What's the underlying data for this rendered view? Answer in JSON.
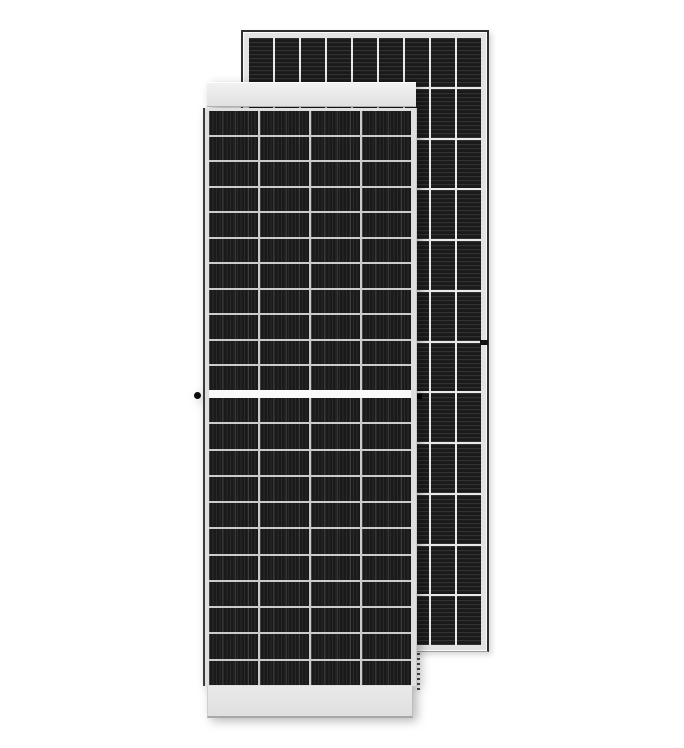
{
  "scene": {
    "description": "Product photo of two framed monocrystalline solar panels on a white background; a portrait half-cut-cell panel in front and a taller panel with horizontally striped cells behind it, offset to the upper right",
    "background_color": "#ffffff"
  },
  "colors": {
    "background": "#ffffff",
    "frame-light": "#e3e3e3",
    "frame-edge-dark": "#3a3a3a",
    "back-outline": "#2e2e2e",
    "cell-dark": "#1a1a1a",
    "gap-front": "#cbcbcb",
    "gap-back": "#e9e9e9",
    "divider": "#fafafa"
  },
  "panels": {
    "front": {
      "label": "front solar panel",
      "orientation": "portrait",
      "cell_texture": "fine vertical busbar stripes",
      "upper_grid": {
        "columns": 4,
        "rows": 11
      },
      "lower_grid": {
        "columns": 4,
        "rows": 11
      },
      "features": [
        "white top frame band",
        "white bottom frame band",
        "white center divider between upper and lower cell halves",
        "small black grounding hole dot on left frame at mid-height"
      ]
    },
    "back": {
      "label": "back solar panel",
      "orientation": "portrait",
      "cell_texture": "fine horizontal busbar stripes",
      "grid": {
        "columns": 9,
        "rows": 12
      },
      "features": [
        "thin dark outline around light gray frame",
        "small black mounting hole mark on right frame",
        "dashed vent detail below bottom-left corner",
        "small black hole mark beside front panel right edge at mid-height"
      ]
    }
  }
}
